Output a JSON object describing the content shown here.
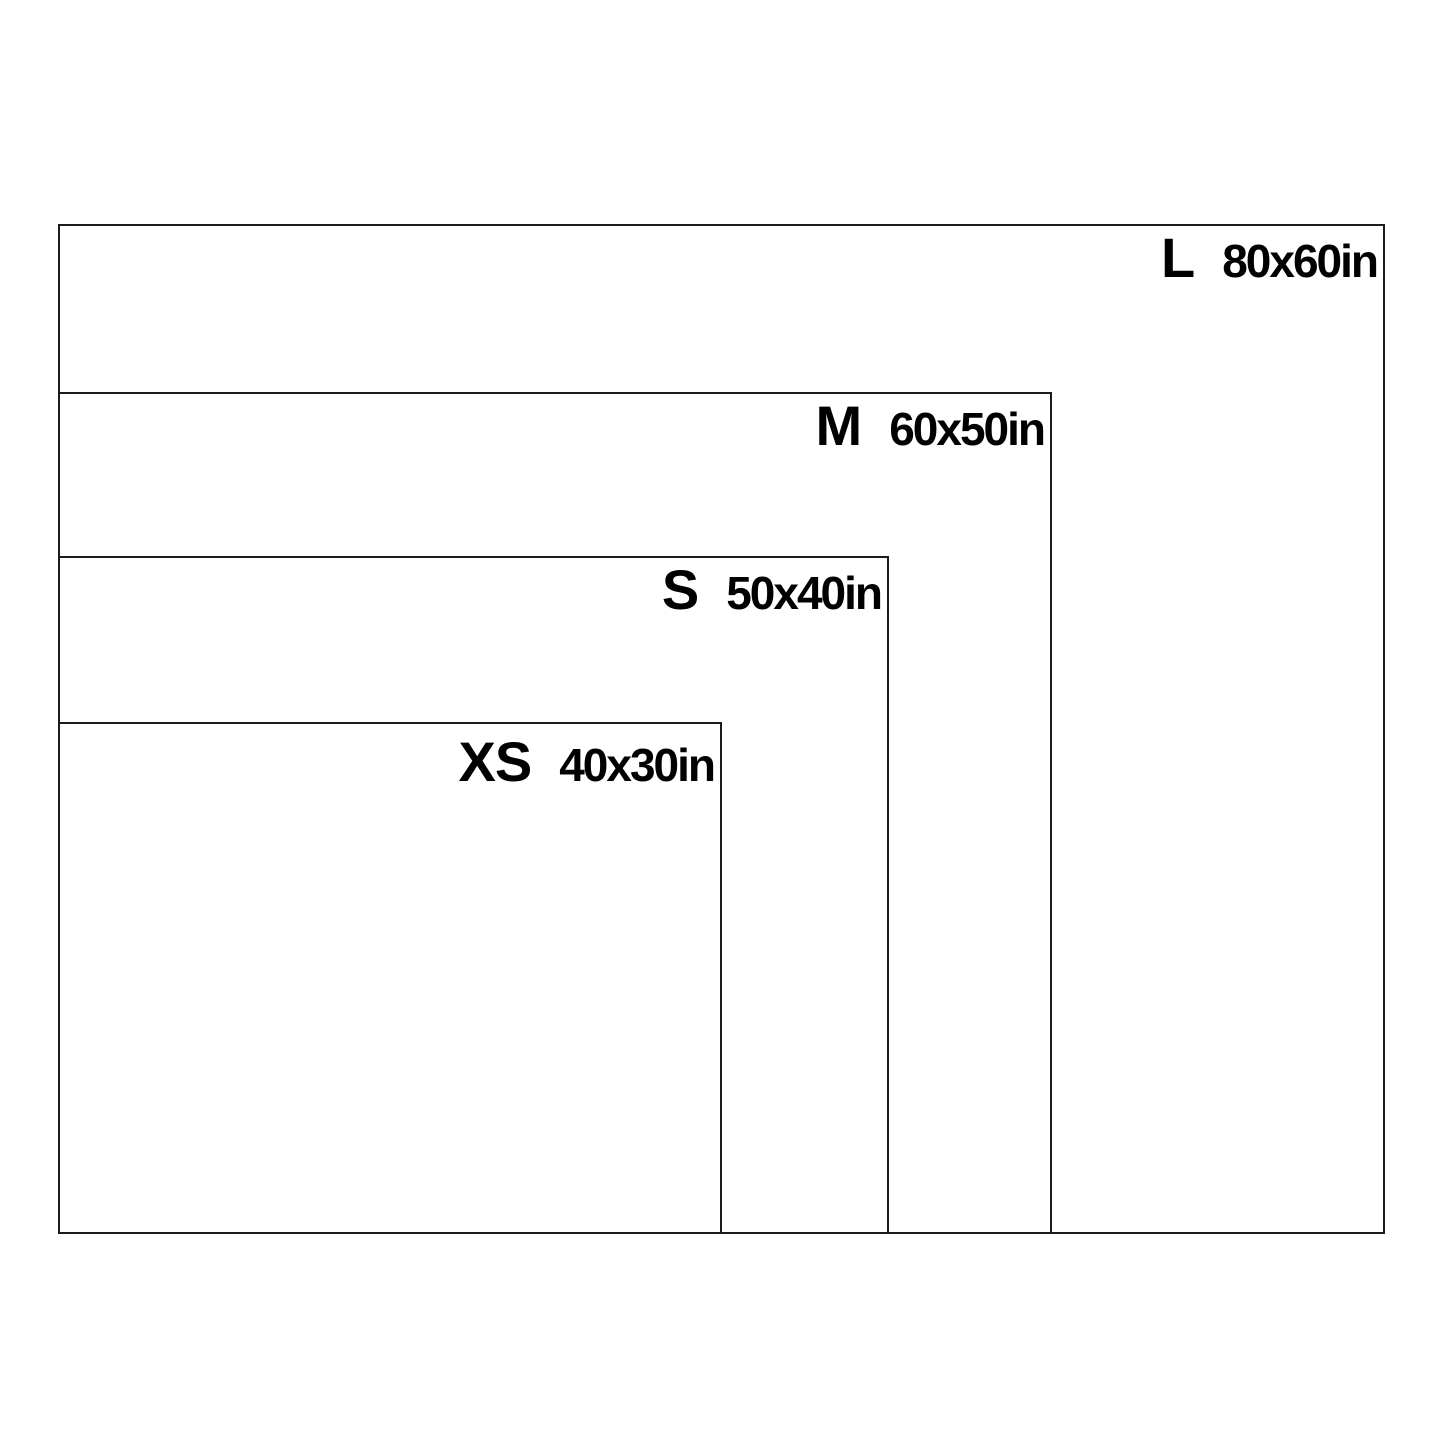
{
  "diagram": {
    "type": "size-comparison-chart",
    "unit": "in",
    "colors": {
      "outline": "#1b1b1b",
      "text": "#000000",
      "background": "#ffffff"
    },
    "sizes": [
      {
        "label": "L",
        "dimensions": "80x60in",
        "width_in": 80,
        "height_in": 60
      },
      {
        "label": "M",
        "dimensions": "60x50in",
        "width_in": 60,
        "height_in": 50
      },
      {
        "label": "S",
        "dimensions": "50x40in",
        "width_in": 50,
        "height_in": 40
      },
      {
        "label": "XS",
        "dimensions": "40x30in",
        "width_in": 40,
        "height_in": 30
      }
    ]
  }
}
